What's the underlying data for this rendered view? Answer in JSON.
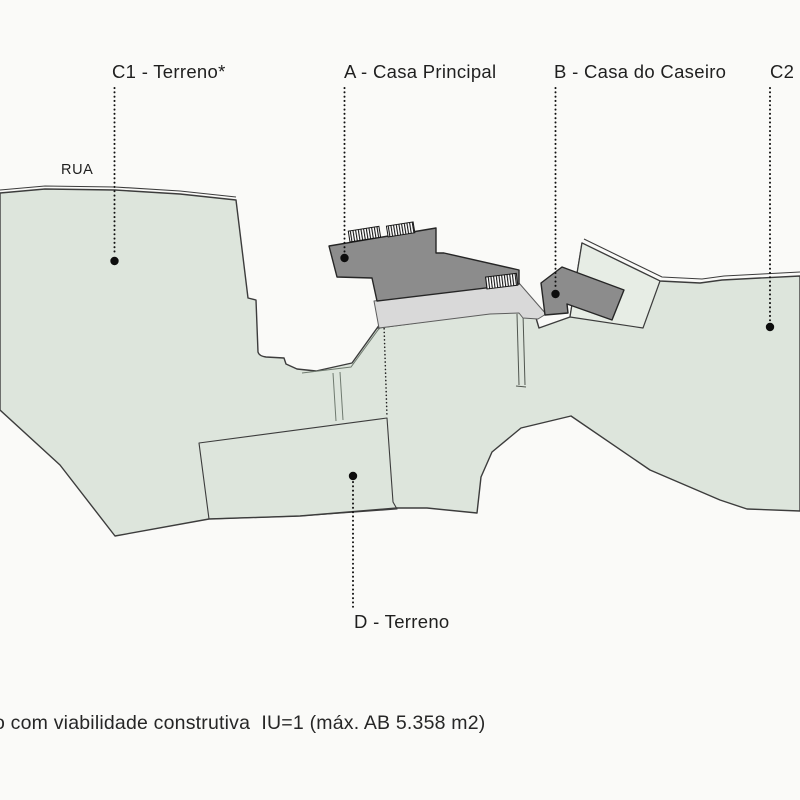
{
  "plan": {
    "labels": {
      "c1": "C1 - Terreno*",
      "a": "A - Casa Principal",
      "b": "B - Casa do Caseiro",
      "c2": "C2",
      "d": "D - Terreno"
    },
    "street_label": "RUA",
    "note": "o com viabilidade construtiva  IU=1 (máx. AB 5.358 m2)",
    "colors": {
      "background": "#fafaf8",
      "terrain": "#dde5dc",
      "parcel_b": "#e7ede5",
      "terrace": "#d9d9d9",
      "building": "#8c8c8c",
      "outline": "#3c3c3c",
      "building_outline": "#262626",
      "leader": "#111111",
      "text": "#1f1f1f"
    }
  }
}
